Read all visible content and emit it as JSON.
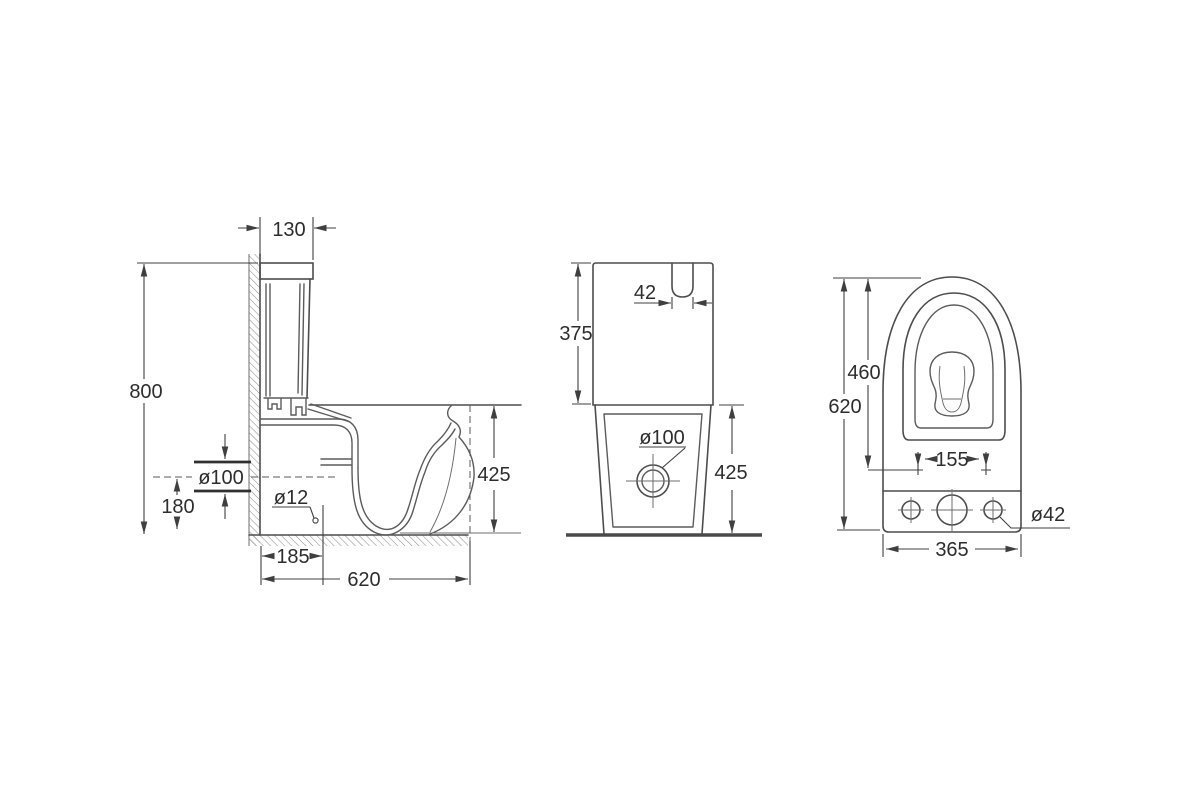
{
  "meta": {
    "type": "technical dimension drawing",
    "subject": "Close-coupled toilet (WC) — three orthographic views",
    "units": "mm"
  },
  "side_view": {
    "name": "Side section view",
    "dims": {
      "tank_depth": "130",
      "overall_height": "800",
      "outlet_diameter": "ø100",
      "outlet_axis_height": "180",
      "fixing_hole_diameter": "ø12",
      "wall_to_fixing_hole": "185",
      "overall_depth": "620",
      "rim_height": "425"
    }
  },
  "front_view": {
    "name": "Front view",
    "dims": {
      "tank_height": "375",
      "flush_button_width": "42",
      "outlet_diameter": "ø100",
      "rim_height": "425"
    }
  },
  "top_view": {
    "name": "Top view",
    "dims": {
      "bowl_front_to_hinge": "460",
      "overall_length": "620",
      "seat_hinge_spacing": "155",
      "inlet_hole_diameter": "ø42",
      "overall_width": "365"
    }
  }
}
